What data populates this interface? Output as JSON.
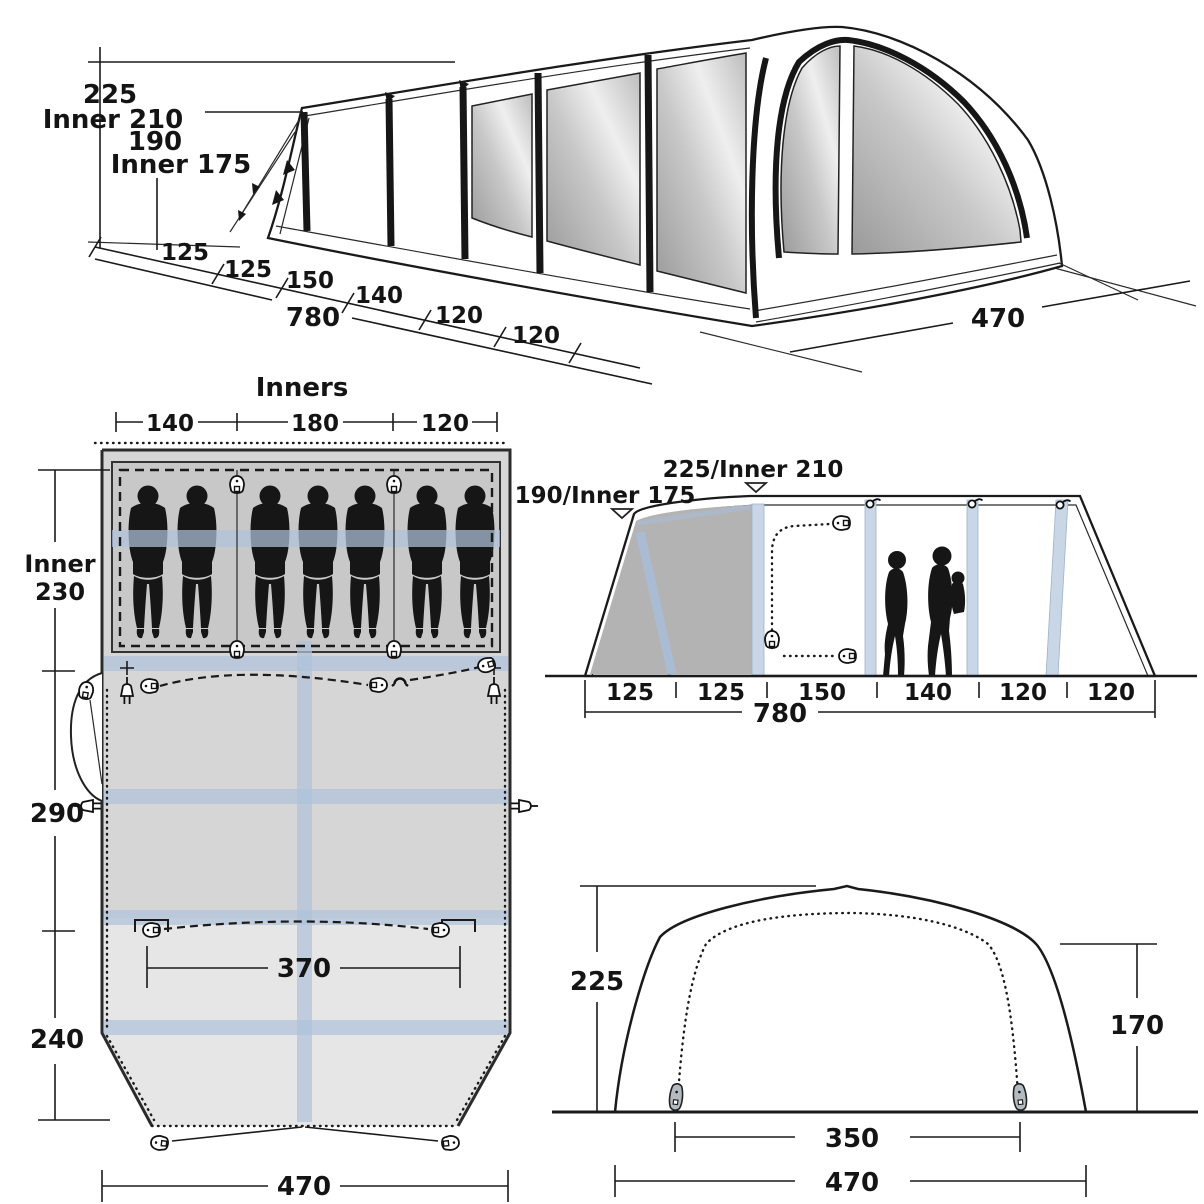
{
  "colors": {
    "line": "#1a1a1a",
    "beam_blue": "#aec2da",
    "plan_inner_gray": "#c8c8c8",
    "plan_body_gray": "#d6d6d6",
    "plan_porch_gray": "#e6e6e6",
    "side_panel_gray": "#b3b3b3",
    "window_dark": "#8e8e8e",
    "window_light": "#f5f5f5",
    "silhouette": "#161616"
  },
  "perspective": {
    "dim_height_top": "225",
    "dim_height_top_inner": "Inner 210",
    "dim_height_front": "190",
    "dim_height_front_inner": "Inner 175",
    "segments": [
      "125",
      "125",
      "150",
      "140",
      "120",
      "120"
    ],
    "dim_length": "780",
    "dim_width": "470"
  },
  "floor_plan": {
    "title": "Inners",
    "top_segments": [
      "140",
      "180",
      "120"
    ],
    "side_inner_label": "Inner",
    "side_inner_value": "230",
    "side_mid": "290",
    "side_bottom": "240",
    "dim_door": "370",
    "dim_width": "470",
    "sleeper_count": 7
  },
  "side_elevation": {
    "label_main_peak": "225/Inner 210",
    "label_front_peak": "190/Inner 175",
    "segments": [
      "125",
      "125",
      "150",
      "140",
      "120",
      "120"
    ],
    "dim_length": "780"
  },
  "front_elevation": {
    "dim_height": "225",
    "dim_wall": "170",
    "dim_door": "350",
    "dim_width": "470"
  }
}
